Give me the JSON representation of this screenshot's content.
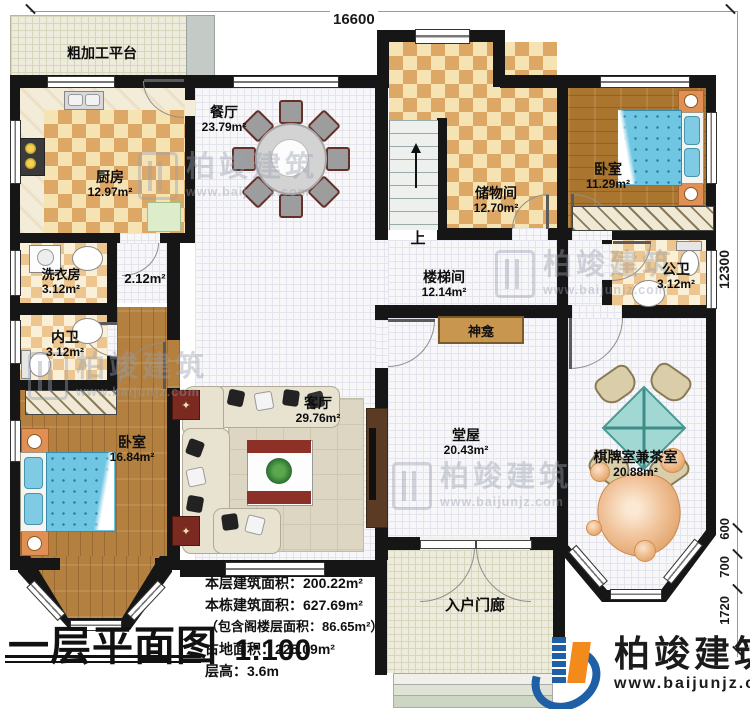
{
  "plan": {
    "dimensions": {
      "top": "16600",
      "right": [
        "12300",
        "600",
        "700",
        "1720"
      ]
    },
    "rooms": {
      "platform": {
        "name": "粗加工平台"
      },
      "kitchen": {
        "name": "厨房",
        "area": "12.97m²"
      },
      "dining": {
        "name": "餐厅",
        "area": "23.79m²"
      },
      "storage": {
        "name": "储物间",
        "area": "12.70m²"
      },
      "bedroom_ne": {
        "name": "卧室",
        "area": "11.29m²"
      },
      "laundry": {
        "name": "洗衣房",
        "area": "3.12m²"
      },
      "hallway": {
        "area": "2.12m²"
      },
      "bath_private": {
        "name": "内卫",
        "area": "3.12m²"
      },
      "bath_public": {
        "name": "公卫",
        "area": "3.12m²"
      },
      "stairwell": {
        "name": "楼梯间",
        "area": "12.14m²"
      },
      "shrine": {
        "name": "神龛"
      },
      "living": {
        "name": "客厅",
        "area": "29.76m²"
      },
      "main_hall": {
        "name": "堂屋",
        "area": "20.43m²"
      },
      "chess_tea": {
        "name": "棋牌室兼茶室",
        "area": "20.88m²"
      },
      "bedroom_sw": {
        "name": "卧室",
        "area": "16.84m²"
      },
      "porch": {
        "name": "入户门廊"
      }
    },
    "stairs": {
      "up_label": "上"
    },
    "watermark": {
      "brand": "柏竣建筑",
      "site": "www.baijunjz.com"
    }
  },
  "title_block": {
    "title": "一层平面图",
    "scale": "1:100",
    "stats": [
      "本层建筑面积：200.22m²",
      "本栋建筑面积：627.69m²",
      "（包含阁楼层面积：86.65m²）",
      "占地面积：225.09m²",
      "层高：3.6m"
    ]
  },
  "branding": {
    "company": "柏竣建筑",
    "website": "www.baijunjz.com"
  },
  "colors": {
    "wall": "#161616",
    "checker_dark": "#dda766",
    "wood": "#b3803f",
    "bed_blue": "#6fc6e2",
    "table_teal": "#a2d8d4",
    "logo_blue": "#1e5fa6",
    "logo_orange": "#f28a1c"
  }
}
